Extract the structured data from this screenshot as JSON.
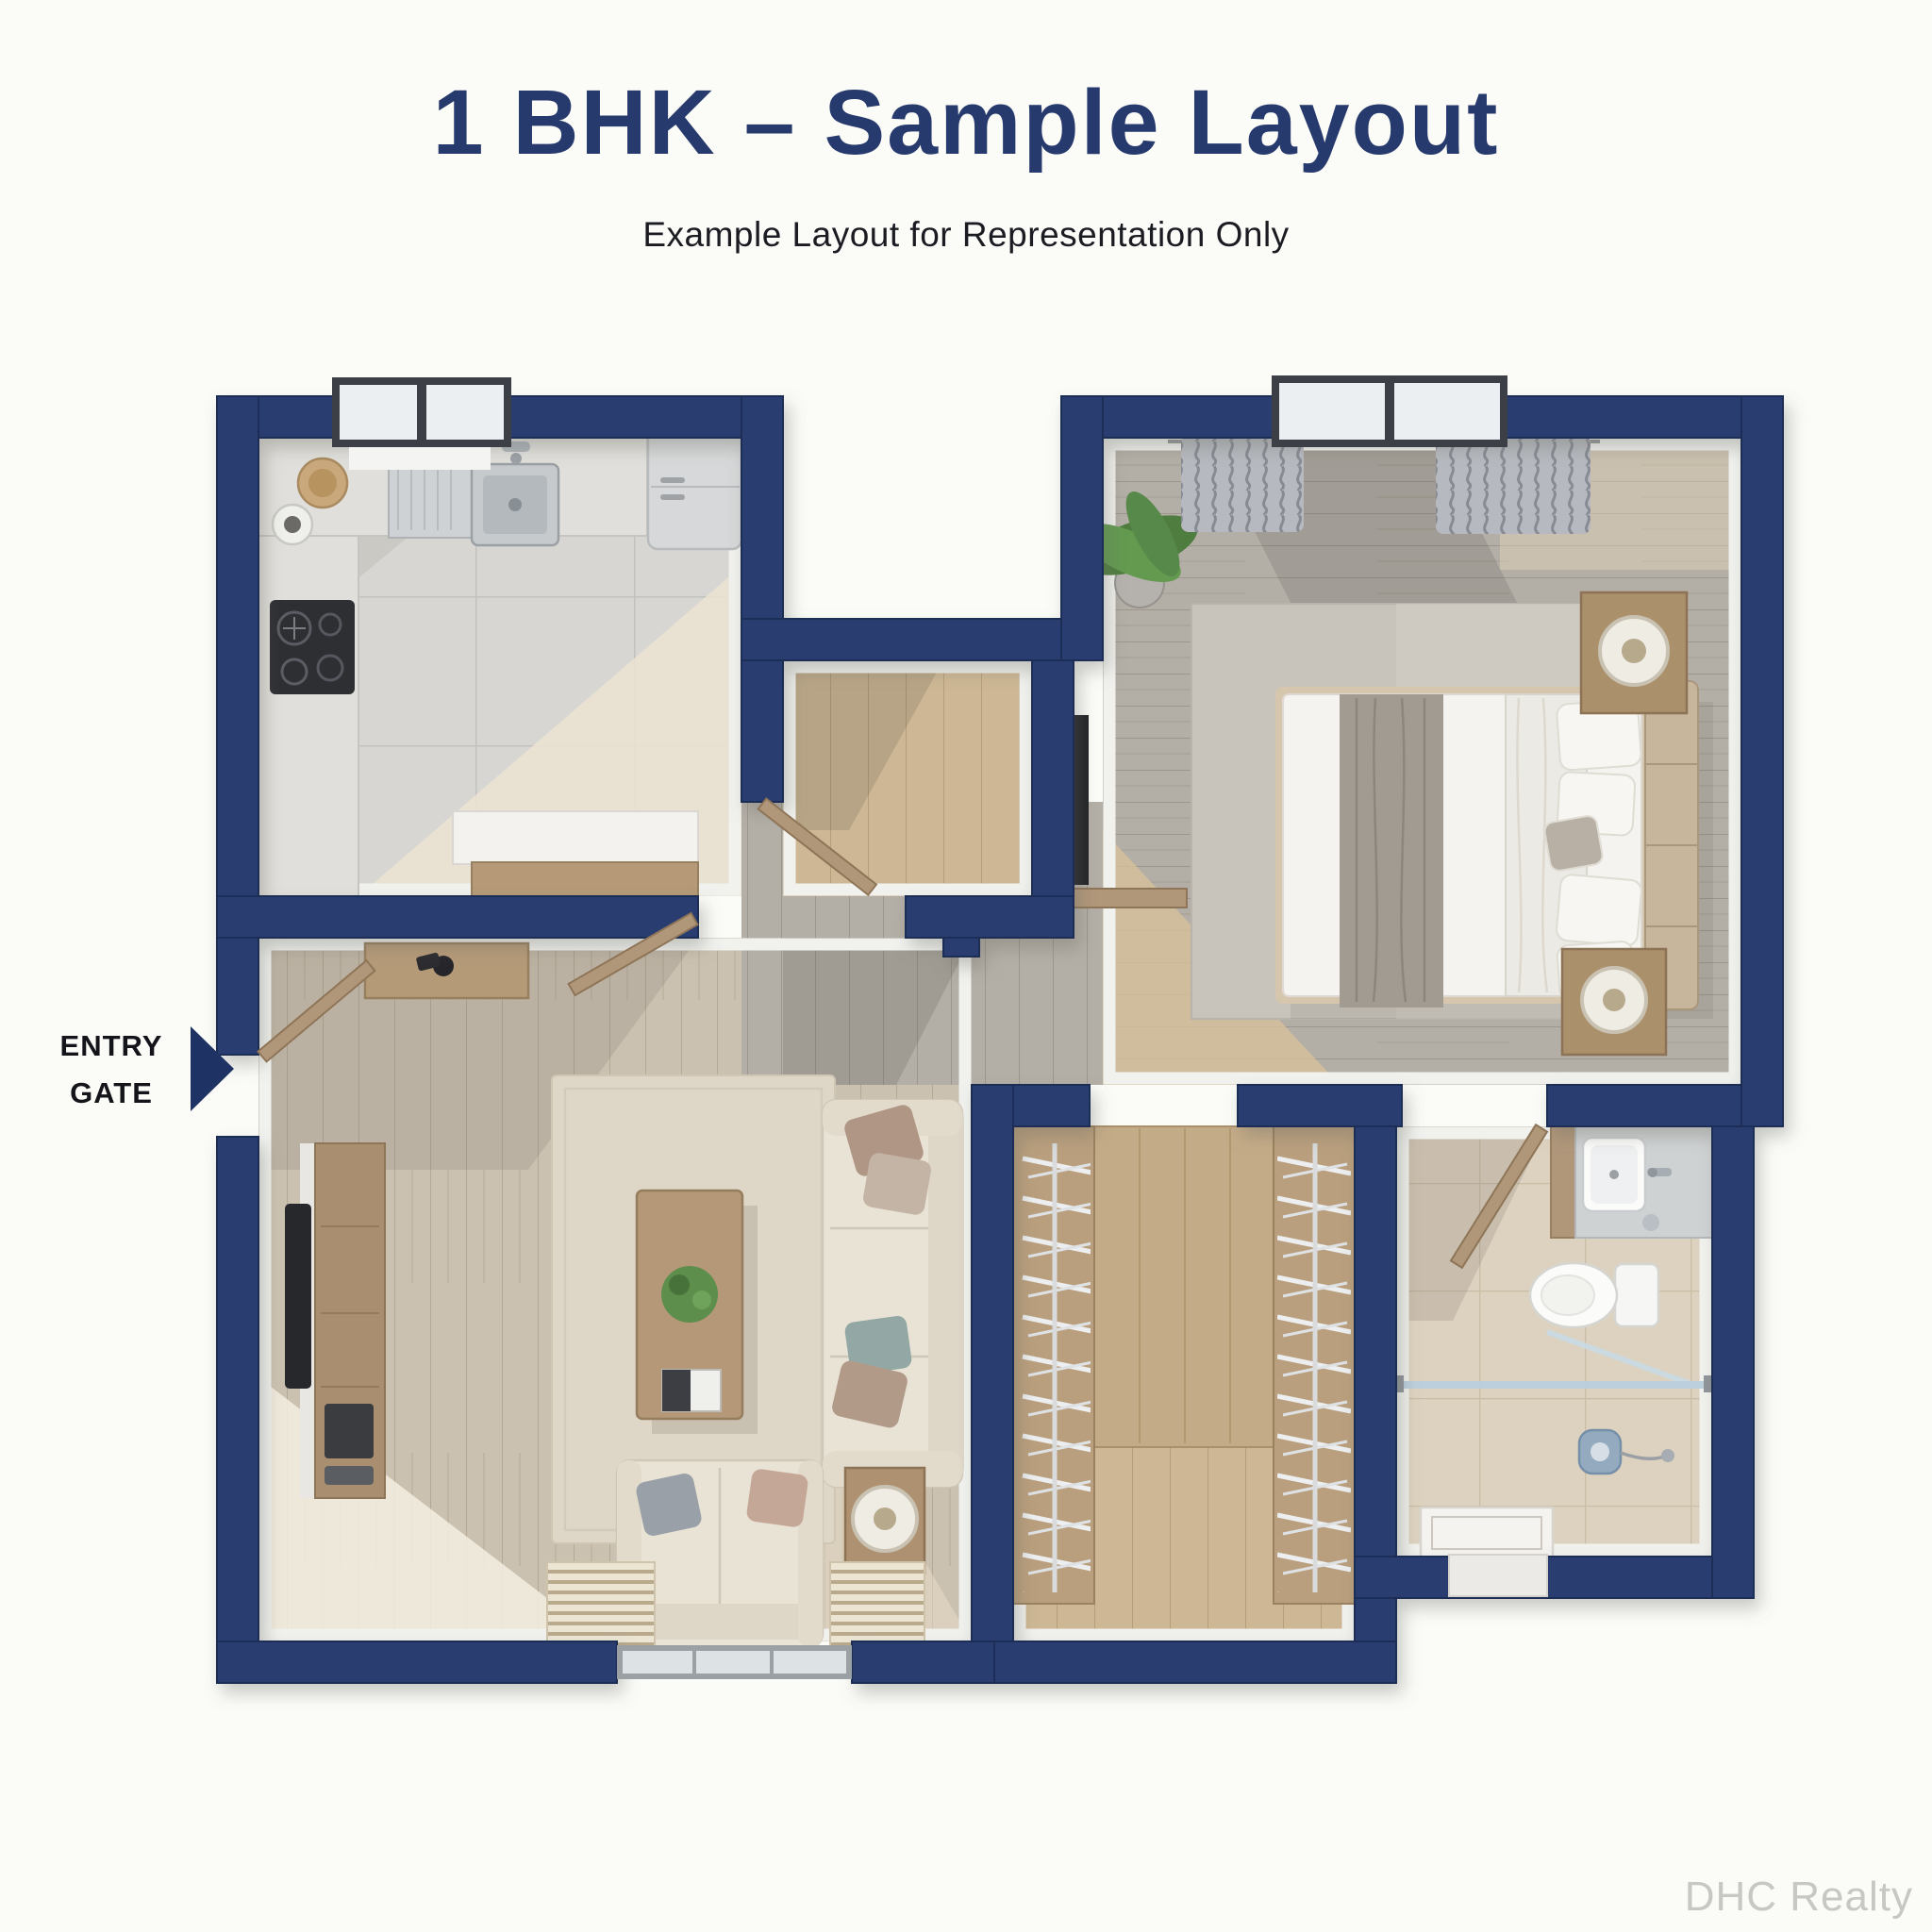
{
  "page": {
    "background_color": "#fbfbf8"
  },
  "header": {
    "title": "1 BHK – Sample Layout",
    "subtitle": "Example Layout for Representation Only",
    "title_color": "#273a6d",
    "subtitle_color": "#1b1c22"
  },
  "entry_gate": {
    "line1": "ENTRY",
    "line2": "GATE",
    "arrow_color": "#1e3263",
    "text_color": "#14151a"
  },
  "watermark": {
    "text": "DHC Realty",
    "color": "#c7c7c4"
  },
  "colors": {
    "wall_navy": "#2c3d6f",
    "wall_navy_dark": "#1e2e57",
    "wall_inner_face": "#f1f1ee",
    "kitchen_tile": "#d7d6d2",
    "wood_tan": "#cdb794",
    "wood_gray": "#b3aea6",
    "wood_living": "#cbc1b0",
    "bathroom_tile": "#ddd2bf",
    "rug_living": "#ded7c7",
    "rug_bedroom": "#c9c4bb",
    "sofa_cream": "#e9e3d6",
    "furniture_wood": "#b1977a",
    "glass_blue": "#b9cfdd",
    "plant_green": "#5e8e4c"
  },
  "floor_plan": {
    "type": "1 BHK apartment, 3D top view",
    "rooms": [
      {
        "name": "kitchen",
        "furniture": [
          "l-counter",
          "sink-with-drainboard",
          "faucet",
          "gas-stove",
          "refrigerator",
          "storage-jar",
          "basket",
          "peninsula-counter",
          "window",
          "door-leaf"
        ]
      },
      {
        "name": "living-room",
        "furniture": [
          "entry-console",
          "entry-door-leaf",
          "tv-unit",
          "television",
          "rug",
          "coffee-table",
          "potted-plant",
          "book",
          "three-seater-sofa",
          "loveseat",
          "cushions",
          "side-table",
          "table-lamp",
          "window",
          "window-blinds"
        ]
      },
      {
        "name": "foyer-alcove",
        "furniture": [
          "open-door-leaf",
          "wall-tv",
          "wood-shelf"
        ]
      },
      {
        "name": "bedroom",
        "furniture": [
          "double-bed",
          "upholstered-headboard",
          "pillows",
          "gray-throw",
          "white-duvet",
          "rug",
          "nightstand-lamp-top",
          "nightstand-lamp-bottom",
          "potted-plant",
          "curtains",
          "window"
        ]
      },
      {
        "name": "wardrobe",
        "furniture": [
          "left-closet-hanging-rail",
          "right-closet-hanging-rail",
          "center-wood-panel"
        ]
      },
      {
        "name": "bathroom",
        "furniture": [
          "vanity-counter",
          "washbasin",
          "faucet",
          "toilet",
          "glass-shower-partition",
          "hand-shower",
          "shower-tray",
          "door-leaf"
        ]
      }
    ],
    "entry": {
      "label": "ENTRY GATE",
      "side": "left"
    }
  }
}
